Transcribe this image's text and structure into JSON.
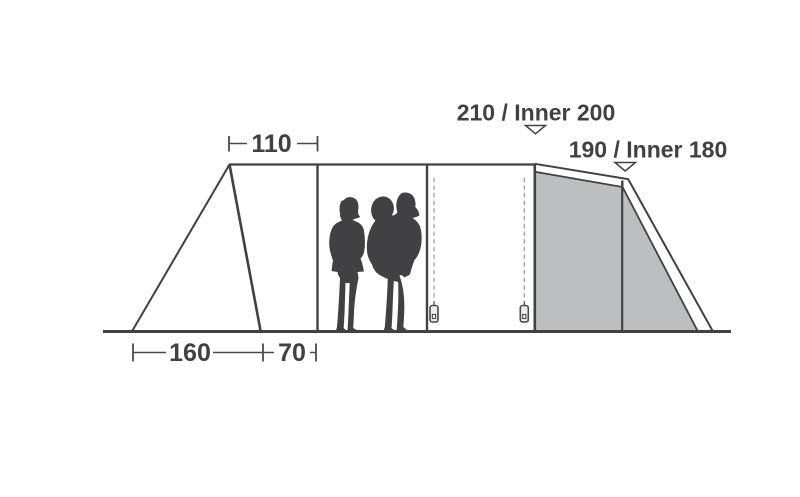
{
  "diagram": {
    "type": "tent-side-profile-dimension-diagram",
    "dimensions": {
      "top_width": "110",
      "front_ground_width": "160",
      "porch_ground_width": "70"
    },
    "heights": {
      "center": "210 / Inner 200",
      "rear": "190 / Inner 180"
    },
    "colors": {
      "line": "#414042",
      "panel_fill": "#bcbec0",
      "dash_line": "#a7a9ac",
      "text": "#414042"
    },
    "icons": {
      "marker": "triangle-down-marker",
      "zipper": "zipper-pull"
    }
  }
}
